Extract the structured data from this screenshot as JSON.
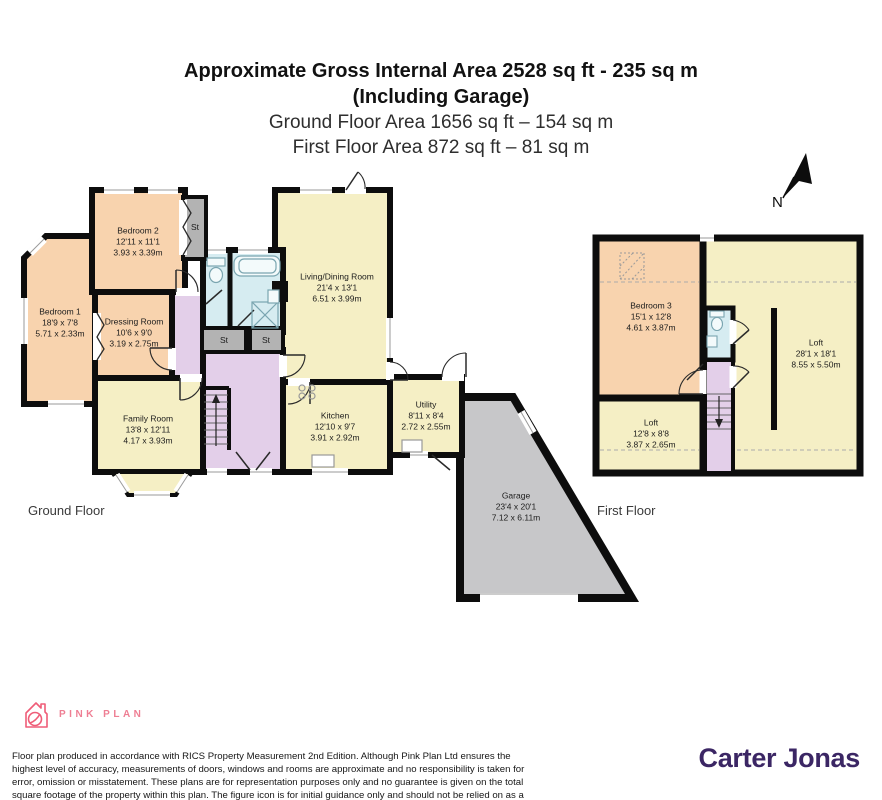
{
  "title": {
    "line1": "Approximate Gross Internal Area 2528 sq ft - 235 sq m",
    "line2": "(Including Garage)",
    "line3": "Ground Floor Area 1656 sq ft – 154 sq m",
    "line4": "First Floor Area 872 sq ft – 81 sq m"
  },
  "compass": {
    "label": "N"
  },
  "ground_floor": {
    "caption": "Ground Floor",
    "closet_label": "St",
    "rooms": {
      "bedroom1": {
        "name": "Bedroom 1",
        "imperial": "18'9 x 7'8",
        "metric": "5.71 x 2.33m"
      },
      "bedroom2": {
        "name": "Bedroom 2",
        "imperial": "12'11 x 11'1",
        "metric": "3.93 x 3.39m"
      },
      "dressing_room": {
        "name": "Dressing Room",
        "imperial": "10'6 x 9'0",
        "metric": "3.19 x 2.75m"
      },
      "family_room": {
        "name": "Family Room",
        "imperial": "13'8 x 12'11",
        "metric": "4.17 x 3.93m"
      },
      "living_dining_room": {
        "name": "Living/Dining Room",
        "imperial": "21'4 x 13'1",
        "metric": "6.51 x 3.99m"
      },
      "kitchen": {
        "name": "Kitchen",
        "imperial": "12'10 x 9'7",
        "metric": "3.91 x 2.92m"
      },
      "utility": {
        "name": "Utility",
        "imperial": "8'11 x 8'4",
        "metric": "2.72 x 2.55m"
      },
      "garage": {
        "name": "Garage",
        "imperial": "23'4 x 20'1",
        "metric": "7.12 x 6.11m"
      }
    }
  },
  "first_floor": {
    "caption": "First Floor",
    "rooms": {
      "bedroom3": {
        "name": "Bedroom 3",
        "imperial": "15'1 x 12'8",
        "metric": "4.61 x 3.87m"
      },
      "loft_main": {
        "name": "Loft",
        "imperial": "28'1 x 18'1",
        "metric": "8.55 x 5.50m"
      },
      "loft_small": {
        "name": "Loft",
        "imperial": "12'8 x 8'8",
        "metric": "3.87 x 2.65m"
      }
    }
  },
  "footer": {
    "brand": "PINK PLAN",
    "disclaimer": "Floor plan produced in accordance with RICS Property Measurement 2nd Edition. Although Pink Plan Ltd ensures the highest level of accuracy, measurements of doors, windows and rooms are approximate and no responsibility is taken for error, omission or misstatement. These plans are for representation purposes only and no guarantee is given on the total square footage of the property within this plan. The figure icon is for initial guidance only and should not be relied on as a basis of valuation.",
    "agent_logo": "Carter Jonas"
  },
  "colors": {
    "room_peach": "#f8d3ae",
    "room_yellow": "#f5efc5",
    "hall_lavender": "#e3cfe9",
    "bath_blue": "#d6ecf1",
    "closet_grey": "#b3b3b3",
    "garage_grey": "#c7c7c9",
    "wall_black": "#0d0d0d",
    "brand_pink": "#ee7e93",
    "agent_purple": "#3b2664"
  }
}
